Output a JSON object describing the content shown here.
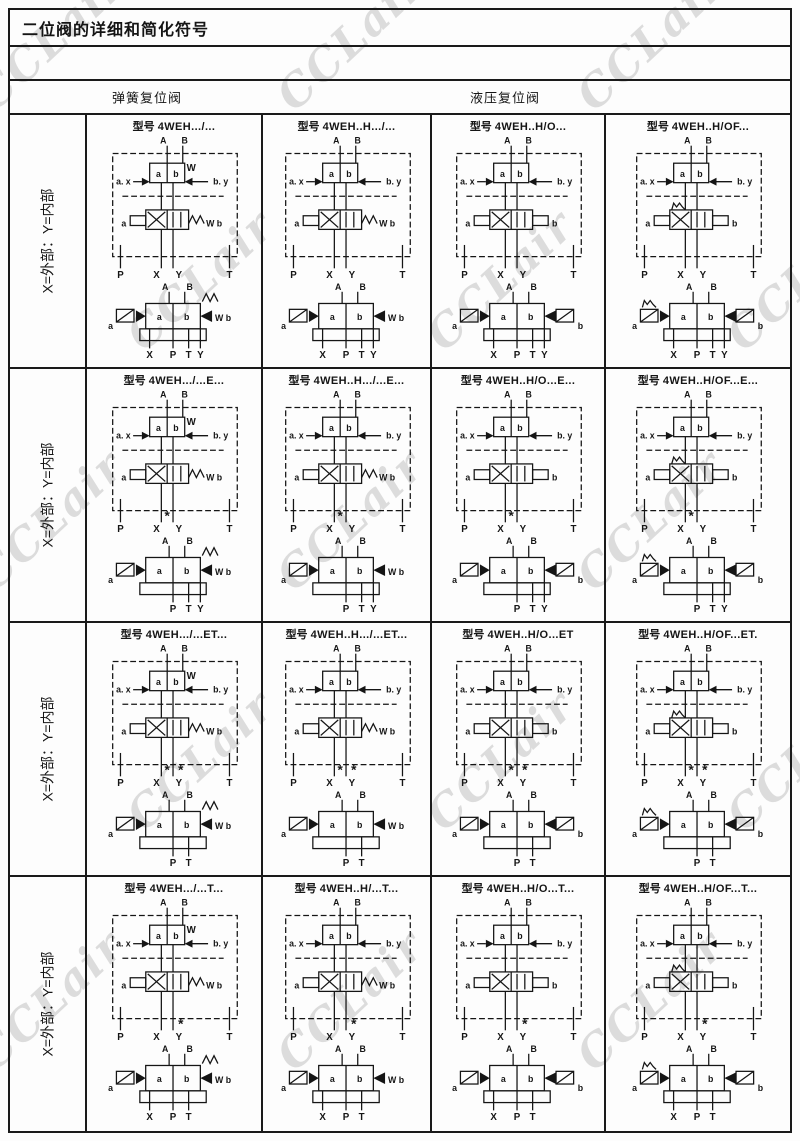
{
  "title": "二位阀的详细和简化符号",
  "header": {
    "spring_return": "弹簧复位阀",
    "hydraulic_return": "液压复位阀"
  },
  "model_prefix": "型号",
  "watermark": {
    "text": "CCLair"
  },
  "labels": {
    "port_a": "A",
    "port_b": "B",
    "port_p": "P",
    "port_x": "X",
    "port_y": "Y",
    "port_t": "T",
    "pilot_left": "a. x",
    "pilot_right": "b. y",
    "sol_a": "a",
    "sol_b": "b",
    "spring": "W",
    "main_spring_right": "W b",
    "plug": "*"
  },
  "columns": [
    {
      "pilot_spring": true,
      "main_right": "spring",
      "simp_right": "spring_triangle",
      "detent": false
    },
    {
      "pilot_spring": false,
      "main_right": "spring",
      "simp_right": "triangle",
      "detent": false
    },
    {
      "pilot_spring": false,
      "main_right": "box",
      "simp_right": "triangle_box",
      "detent": false
    },
    {
      "pilot_spring": false,
      "main_right": "box",
      "simp_right": "triangle_box",
      "detent": true
    }
  ],
  "rows": [
    {
      "label": "X=外部：Y=内部",
      "x_plugged": false,
      "y_plugged": false,
      "simplified_ports": [
        "X",
        "P",
        "T",
        "Y"
      ],
      "models": [
        "4WEH.../...",
        "4WEH..H.../...",
        "4WEH..H/O...",
        "4WEH..H/OF..."
      ]
    },
    {
      "label": "X=外部：Y=内部",
      "x_plugged": true,
      "y_plugged": false,
      "simplified_ports": [
        "P",
        "T",
        "Y"
      ],
      "models": [
        "4WEH.../...E...",
        "4WEH..H.../...E...",
        "4WEH..H/O...E...",
        "4WEH..H/OF...E..."
      ]
    },
    {
      "label": "X=外部：Y=内部",
      "x_plugged": true,
      "y_plugged": true,
      "simplified_ports": [
        "P",
        "T"
      ],
      "models": [
        "4WEH.../...ET...",
        "4WEH..H.../...ET...",
        "4WEH..H/O...ET",
        "4WEH..H/OF...ET."
      ]
    },
    {
      "label": "X=外部：Y=内部",
      "x_plugged": false,
      "y_plugged": true,
      "simplified_ports": [
        "X",
        "P",
        "T"
      ],
      "models": [
        "4WEH.../...T...",
        "4WEH..H/...T...",
        "4WEH..H/O...T...",
        "4WEH..H/OF...T..."
      ]
    }
  ]
}
